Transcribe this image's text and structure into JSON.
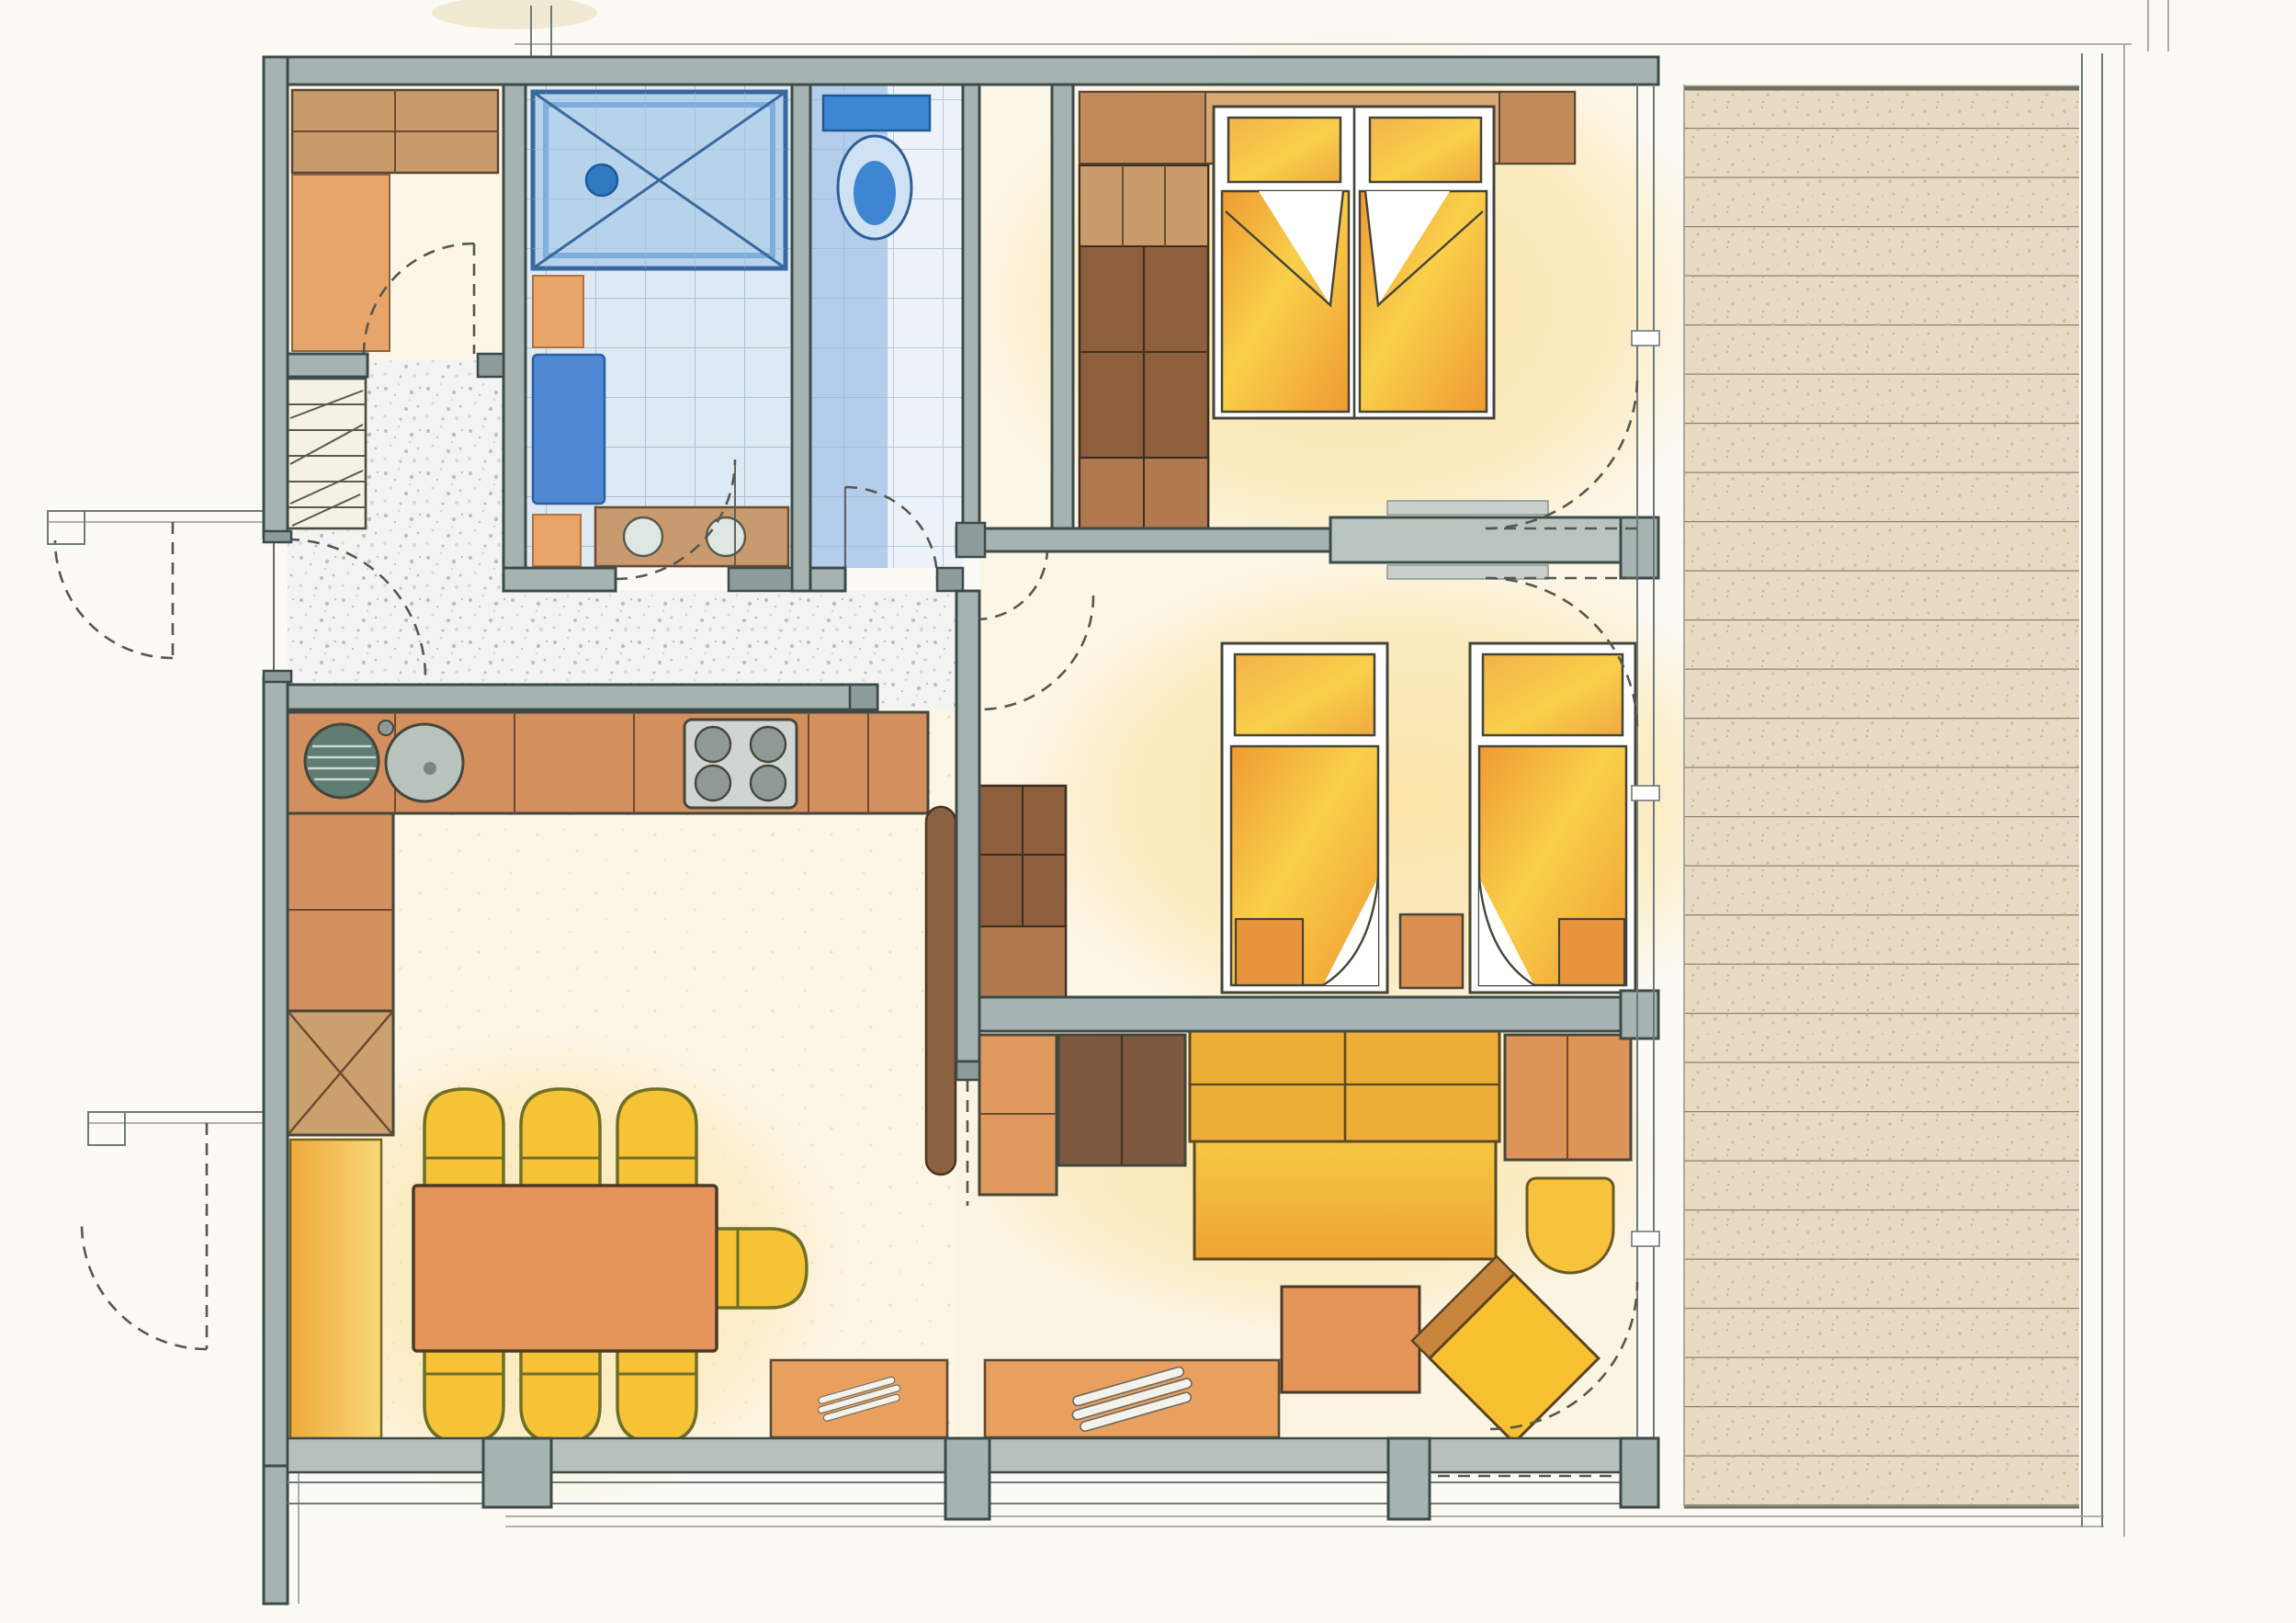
{
  "document": {
    "title": "Hand-drawn apartment floor plan, colored pencil rendering, top-down view",
    "type": "architectural-floor-plan",
    "style": "colored pencil on scanned paper",
    "visible_text": "none"
  },
  "palette": {
    "paper": "#fbfaf5",
    "cream": "#fcf6e7",
    "cream2": "#fbf4e2",
    "wall_fill": "#a7b3b0",
    "wall_cap": "#8d9c9a",
    "wall_stroke": "#3c4b4a",
    "ink": "#45463c",
    "line_thin": "#6f7a78",
    "line_faint": "#9a9a92",
    "dash": "#57574f",
    "speckle1": "#b9bfc9",
    "speckle2": "#d4d8dd",
    "hall_bg": "#f3f3f1",
    "tile_blue_bg": "#dde9f3",
    "tile_blue_line": "#9cb8d2",
    "tile_pale": "#ecf2f7",
    "shower_fill": "#b7d3ec",
    "shower_line": "#39689c",
    "shower_rim": "#5d9ad2",
    "drain_blue": "#2f7ac0",
    "mat_blue": "#4e88d3",
    "wc_blue": "#3f86d2",
    "wc_bowl": "#cfe2f4",
    "accent_orange": "#e8a569",
    "wood_dark": "#8d5f3c",
    "wood_mid": "#b07a4e",
    "wood_light": "#c99a6a",
    "wood_deep": "#6e4a30",
    "band_brown": "#d8a873",
    "counter": "#d48f5f",
    "counter_dark": "#b5713c",
    "steel": "#cfd6d2",
    "steel_dark": "#8f9a96",
    "sink_drain": "#5f7d72",
    "duvet_yellow": "#f9d04a",
    "duvet_orange": "#ef9a33",
    "pillow": "#f7e086",
    "chair_yellow": "#f5c335",
    "chair_line": "#6f6f28",
    "sofa_back": "#edae38",
    "sofa_seat": "#f8cf55",
    "table_orange": "#e5945a",
    "radiator": "#e9a05f",
    "bench_deep": "#f0a93a",
    "bench_soft": "#f8d878",
    "deck_bg": "#e7dbc6",
    "deck_line": "#8d7e68",
    "glow": "#fae3a4",
    "leaf_brown": "#8a6242",
    "slider": "#b9c4bf"
  },
  "rooms": [
    {
      "id": "hall",
      "name": "entrance hall",
      "floor": "gray speckled screed",
      "features": [
        "entrance door with swing arc",
        "shoe shelf rack",
        "canopy lines outside"
      ]
    },
    {
      "id": "storage",
      "name": "storage room",
      "floor": "cream",
      "features": [
        "wardrobe shelf band",
        "orange side shelf",
        "inward swinging door"
      ]
    },
    {
      "id": "bathroom",
      "name": "shower bathroom",
      "floor": "pale blue tiles",
      "features": [
        "tiled shower tray with drain",
        "blue bath mat",
        "orange accent tiles",
        "vanity with two basins",
        "door with swing arc"
      ]
    },
    {
      "id": "wc",
      "name": "separate WC",
      "floor": "blue and pale tiles",
      "features": [
        "toilet with cistern",
        "door with swing arc"
      ]
    },
    {
      "id": "closet",
      "name": "hall closet niche",
      "floor": "cream",
      "features": [
        "door with swing arc"
      ]
    },
    {
      "id": "bedroom1",
      "name": "bedroom with double bed",
      "floor": "cream with warm glow",
      "features": [
        "double bed with two pillows and folded duvets",
        "headboard shelf band",
        "tall wardrobe",
        "sliding door partition",
        "balcony door with swing arc"
      ]
    },
    {
      "id": "bedroom2",
      "name": "bedroom with twin beds",
      "floor": "cream with warm glow",
      "features": [
        "two single beds with folded-back duvets",
        "nightstand",
        "wardrobe",
        "entry door swing arc",
        "balcony door with swing arc"
      ]
    },
    {
      "id": "kitchen_dining",
      "name": "kitchen and dining area",
      "floor": "cream",
      "features": [
        "L-shaped counter",
        "double sink with drainer",
        "four-burner stove",
        "appliance block with X symbol",
        "wall bench strip",
        "dining table with seven chairs",
        "radiator"
      ]
    },
    {
      "id": "living",
      "name": "living room",
      "floor": "cream",
      "features": [
        "sideboard row",
        "TV cabinet",
        "three-seat sofa",
        "tub chair",
        "coffee table",
        "rotated armchair",
        "two radiators",
        "open door leaf panel",
        "balcony door with swing arc"
      ]
    }
  ],
  "exterior": {
    "deck": {
      "name": "wooden deck",
      "boards": "horizontal planks",
      "side": "right"
    },
    "window_band_bottom": {
      "name": "bottom window band with mullion posts"
    },
    "window_wall_right": {
      "name": "right glazed wall with two posts"
    }
  },
  "counts": {
    "dining_chairs": 7,
    "single_beds": 2,
    "double_beds": 1,
    "radiators": 2,
    "stove_burners": 4
  }
}
